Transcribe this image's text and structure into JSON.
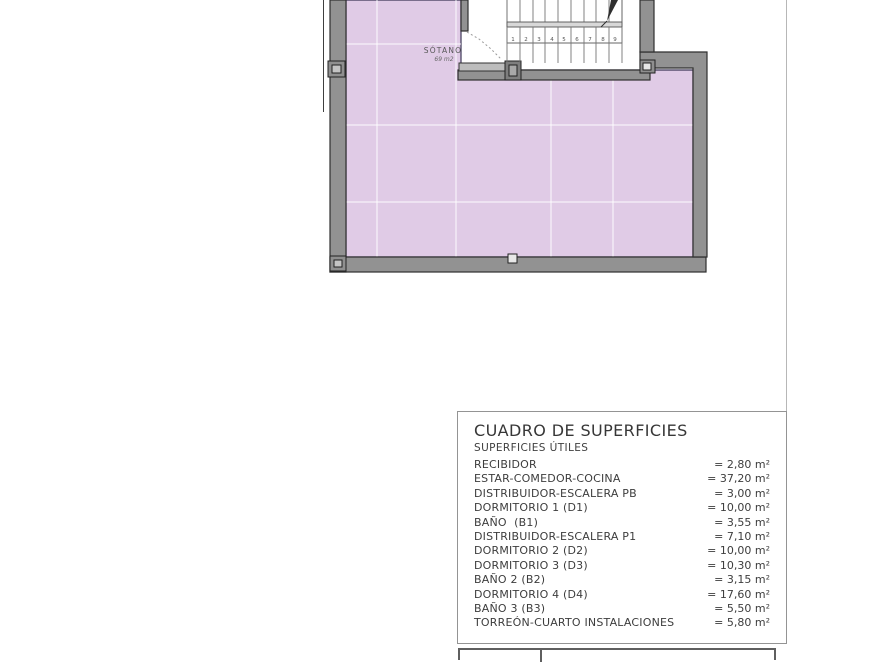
{
  "plan": {
    "room_label": "SÓTANO",
    "room_area": "69 m2",
    "stair_numbers": [
      "1",
      "2",
      "3",
      "4",
      "5",
      "6",
      "7",
      "8",
      "9"
    ],
    "colors": {
      "floor_fill": "#e0cbe6",
      "floor_outline": "#3d3757",
      "grid_line": "#ffffff",
      "wall_fill": "#929292",
      "wall_stroke": "#2f2f2f",
      "post_inner": "#c4c4c4",
      "stair_line": "#757575"
    }
  },
  "surfaces_table": {
    "title": "CUADRO DE SUPERFICIES",
    "subtitle": "SUPERFICIES ÚTILES",
    "rows": [
      {
        "label": "RECIBIDOR",
        "value": "= 2,80 m²"
      },
      {
        "label": "ESTAR-COMEDOR-COCINA",
        "value": "= 37,20 m²"
      },
      {
        "label": "DISTRIBUIDOR-ESCALERA PB",
        "value": "= 3,00 m²"
      },
      {
        "label": "DORMITORIO 1 (D1)",
        "value": "= 10,00 m²"
      },
      {
        "label": "BAÑO  (B1)",
        "value": "= 3,55 m²"
      },
      {
        "label": "DISTRIBUIDOR-ESCALERA P1",
        "value": "= 7,10 m²"
      },
      {
        "label": "DORMITORIO 2 (D2)",
        "value": "= 10,00 m²"
      },
      {
        "label": "DORMITORIO 3 (D3)",
        "value": "= 10,30 m²"
      },
      {
        "label": "BAÑO 2 (B2)",
        "value": "= 3,15 m²"
      },
      {
        "label": "DORMITORIO 4 (D4)",
        "value": "= 17,60 m²"
      },
      {
        "label": "BAÑO 3 (B3)",
        "value": "= 5,50 m²"
      },
      {
        "label": "TORREÓN-CUARTO INSTALACIONES",
        "value": "= 5,80 m²"
      }
    ]
  }
}
